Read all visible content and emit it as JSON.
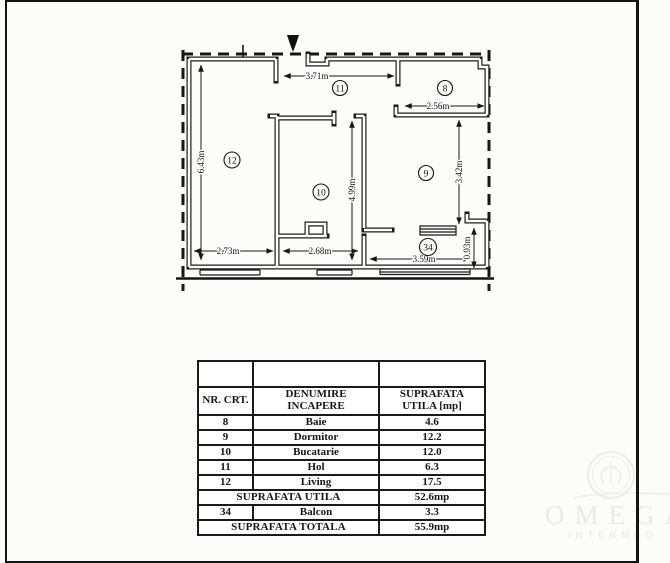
{
  "plan": {
    "room_labels": {
      "bath": "8",
      "bedroom": "9",
      "kitchen": "10",
      "hall": "11",
      "living": "12",
      "balcony": "34"
    },
    "dimensions": {
      "hall_width": "3.71m",
      "bath_width": "2.56m",
      "living_height": "6.43m",
      "kitchen_height": "4.99m",
      "bedroom_height": "3.42m",
      "living_width": "2.73m",
      "kitchen_width": "2.68m",
      "balcony_width": "3.59m",
      "balcony_depth": "0.93m"
    }
  },
  "table": {
    "headers": {
      "col1": "NR. CRT.",
      "col2": "DENUMIRE INCAPERE",
      "col3": "SUPRAFATA UTILA [mp]"
    },
    "rows": [
      {
        "nr": "8",
        "name": "Baie",
        "area": "4.6"
      },
      {
        "nr": "9",
        "name": "Dormitor",
        "area": "12.2"
      },
      {
        "nr": "10",
        "name": "Bucatarie",
        "area": "12.0"
      },
      {
        "nr": "11",
        "name": "Hol",
        "area": "6.3"
      },
      {
        "nr": "12",
        "name": "Living",
        "area": "17.5"
      }
    ],
    "subtotal": {
      "label": "SUPRAFATA UTILA",
      "value": "52.6mp"
    },
    "balcony_row": {
      "nr": "34",
      "name": "Balcon",
      "area": "3.3"
    },
    "total": {
      "label": "SUPRAFATA TOTALA",
      "value": "55.9mp"
    }
  },
  "watermark": {
    "brand": "OMEGA",
    "sub": "INTERMED"
  }
}
